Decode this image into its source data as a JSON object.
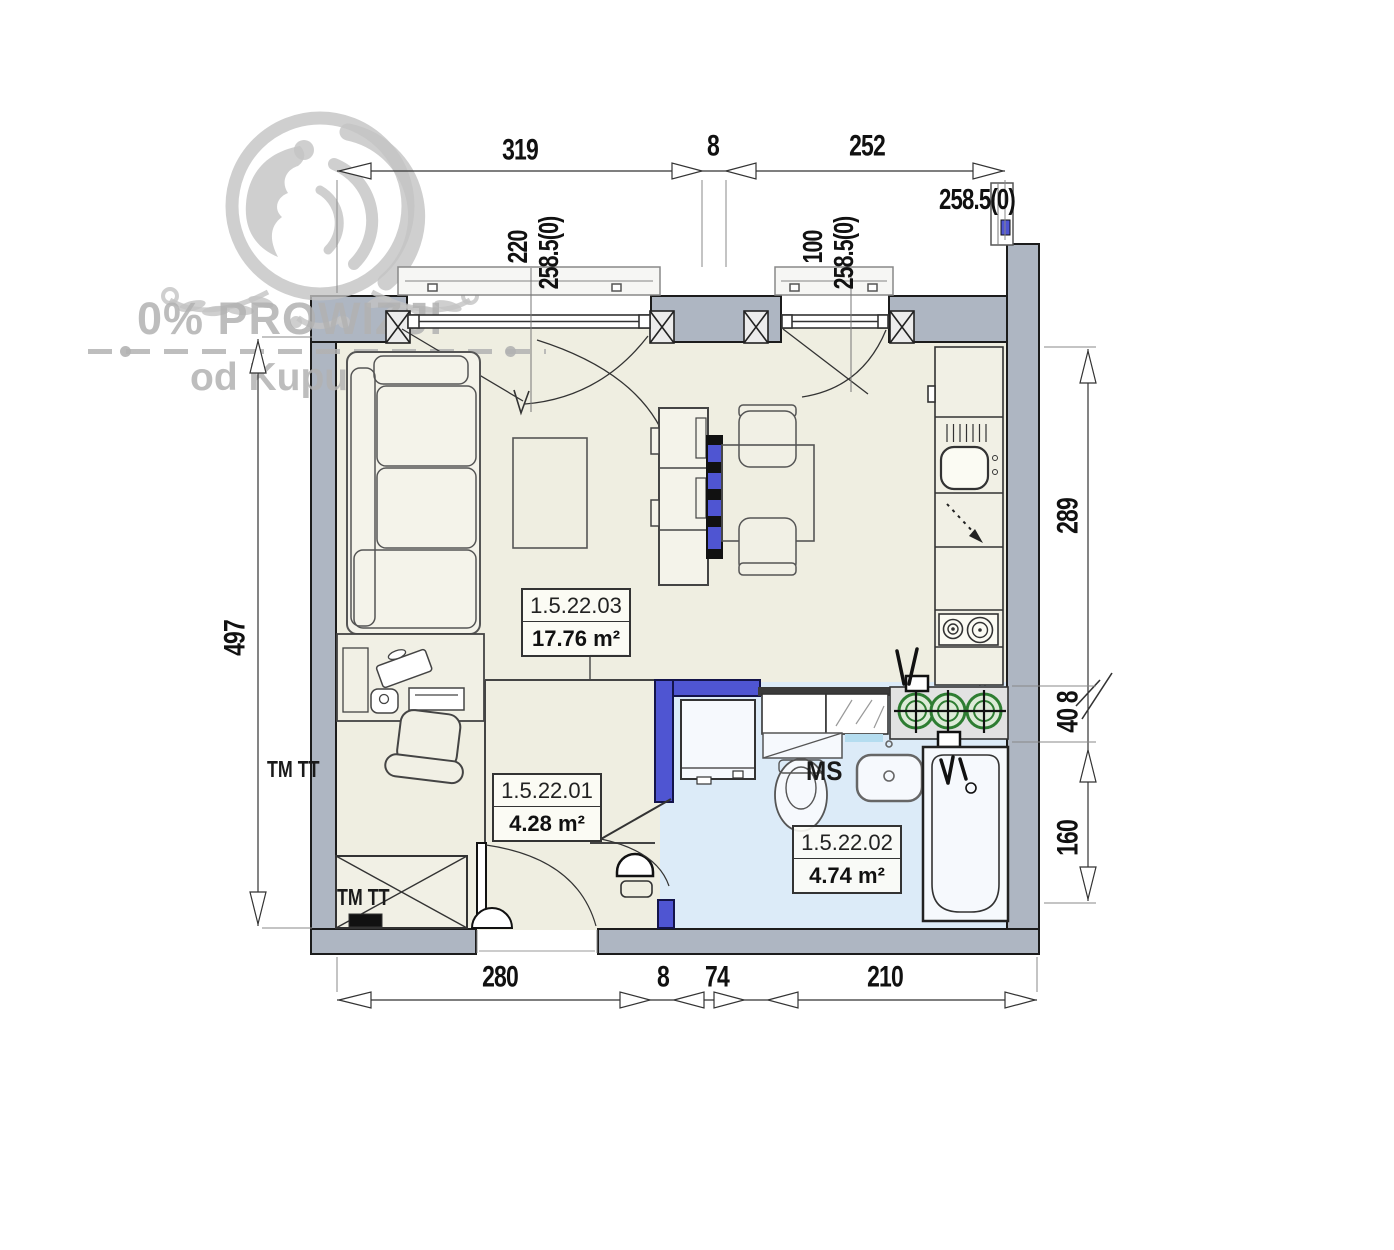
{
  "watermark": {
    "headline": "0% PROWIZJI",
    "subline": "od Kupującego"
  },
  "dimensions": {
    "top": [
      "319",
      "8",
      "252"
    ],
    "top_right": "258.5(0)",
    "bottom": [
      "280",
      "8",
      "74",
      "210"
    ],
    "left": "497",
    "right": [
      "289",
      "40 8",
      "160"
    ],
    "window_left": [
      "220",
      "258.5(0)"
    ],
    "window_right": [
      "100",
      "258.5(0)"
    ]
  },
  "rooms": [
    {
      "id": "1.5.22.03",
      "area": "17.76 m²"
    },
    {
      "id": "1.5.22.01",
      "area": "4.28 m²"
    },
    {
      "id": "1.5.22.02",
      "area": "4.74 m²"
    }
  ],
  "annotations": {
    "wall_label": "TM TT",
    "wardrobe_label": "TM TT",
    "bathroom_label": "MS"
  },
  "colors": {
    "wall": "#aeb6c2",
    "floor": "#efeee1",
    "bathroom_floor": "#dcebf8",
    "accent_blue": "#4f55d2",
    "riser_green": "#2e7d32",
    "watermark": "#b2b2b2"
  }
}
